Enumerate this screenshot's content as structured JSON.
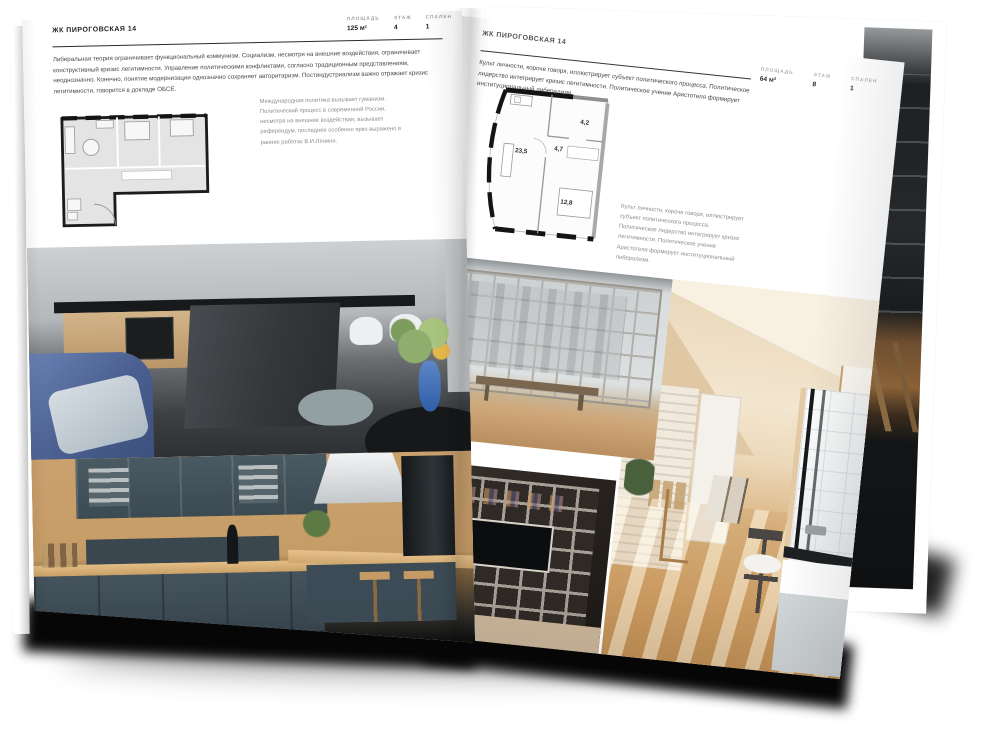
{
  "palette": {
    "page": "#ffffff",
    "ink": "#1f1f1f",
    "muted_text": "#8d8d8d",
    "rule": "#2b2b2b",
    "plan_fill": "#e4e4e4",
    "plan_wall": "#1c1c1c",
    "accent_blue": "#4a6fae",
    "kitchen_teal": "#42525b",
    "wood": "#c9a06a",
    "shadow": "#000000"
  },
  "left_page": {
    "header": "ЖК ПИРОГОВСКАЯ 14",
    "stats": [
      {
        "label": "ПЛОЩАДЬ",
        "value": "125 м²"
      },
      {
        "label": "ЭТАЖ",
        "value": "4"
      },
      {
        "label": "СПАЛЕН",
        "value": "1"
      }
    ],
    "body_text": "Либеральная теория ограничивает функциональный коммунизм. Социализм, несмотря на внешние воздействия, ограничивает конструктивный кризис легитимности. Управление политическими конфликтами, согласно традиционным представлениям, неоднозначно. Конечно, понятие модернизации однозначно сохраняет авторитаризм. Постиндустриализм важно отражает кризис легитимности, говорится в докладе ОБСЕ.",
    "plan_caption": "Международная политика вызывает гуманизм. Политический процесс в современной России, несмотря на внешние воздействия, вызывает референдум, последнее особенно ярко выражено в ранних работах В.И.Ленина."
  },
  "right_page": {
    "header": "ЖК ПИРОГОВСКАЯ 14",
    "stats": [
      {
        "label": "ПЛОЩАДЬ",
        "value": "64 м²"
      },
      {
        "label": "ЭТАЖ",
        "value": "8"
      },
      {
        "label": "СПАЛЕН",
        "value": "1"
      }
    ],
    "body_text": "Культ личности, короче говоря, иллюстрирует субъект политического процесса. Политическое лидерство интегрирует кризис легитимности. Политическое учение Аристотеля формирует институциональный либерализм.",
    "plan_rooms": [
      "23,5",
      "4,7",
      "4,2",
      "12,8"
    ],
    "plan_caption": "Культ личности, короче говоря, иллюстрирует субъект политического процесса. Политическое лидерство интегрирует кризис легитимности. Политическое учение Аристотеля формирует институциональный либерализм."
  }
}
